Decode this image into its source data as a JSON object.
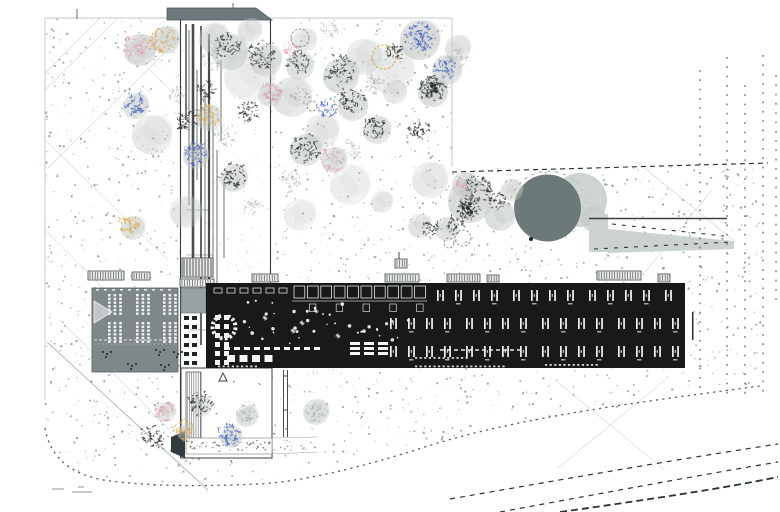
{
  "title": "Architectural site plan",
  "canvas": {
    "w": 780,
    "h": 512,
    "bg": "#ffffff"
  },
  "palette": {
    "ink": "#1c2022",
    "building_black": "#17191a",
    "building_gray": "#7f8789",
    "cap_gray": "#6e797c",
    "circle_gray": "#6b7a78",
    "ramp_gray": "#ccd3cf",
    "canopy": "#c2c8c4",
    "stipple": "#76857f",
    "white": "#f4f5f4",
    "tree_black": "#23282a",
    "tree_dark": "#2b3234",
    "tree_pink": "#dc9aa6",
    "tree_blue": "#3a57c8",
    "tree_orange": "#dfa23e",
    "tree_gray": "#9aa39e"
  },
  "ground": {
    "field_polygon": [
      [
        45,
        18
      ],
      [
        452,
        18
      ],
      [
        452,
        167
      ],
      [
        766,
        167
      ],
      [
        760,
        386
      ],
      [
        640,
        404
      ],
      [
        520,
        423
      ],
      [
        428,
        444
      ],
      [
        340,
        463
      ],
      [
        258,
        484
      ],
      [
        150,
        486
      ],
      [
        95,
        480
      ],
      [
        60,
        462
      ],
      [
        45,
        430
      ]
    ],
    "stipple_count": 2200,
    "tick_count": 140,
    "border_lines": [
      [
        45,
        18,
        452,
        18
      ],
      [
        45,
        18,
        45,
        400
      ],
      [
        452,
        18,
        452,
        167
      ]
    ],
    "diagonals": [
      [
        118,
        18,
        45,
        90,
        0.3
      ],
      [
        200,
        18,
        48,
        168,
        0.3
      ],
      [
        45,
        140,
        168,
        260,
        0.28
      ],
      [
        45,
        230,
        150,
        335,
        0.28
      ],
      [
        60,
        320,
        170,
        430,
        0.3
      ],
      [
        140,
        60,
        262,
        182,
        0.22
      ],
      [
        100,
        18,
        45,
        73,
        0.3
      ],
      [
        637,
        162,
        733,
        240,
        0.35
      ],
      [
        712,
        190,
        645,
        272,
        0.3
      ],
      [
        555,
        380,
        665,
        470,
        0.3
      ],
      [
        665,
        380,
        558,
        468,
        0.3
      ],
      [
        47,
        342,
        208,
        490,
        0.55
      ]
    ],
    "boundary_path": "M45,428 C50,458 72,476 110,481 C160,487 210,486 258,484 C300,482 360,468 428,446 C520,417 640,402 760,386",
    "top_ticks": [
      [
        77,
        9,
        77,
        19
      ],
      [
        233,
        3,
        233,
        9
      ]
    ],
    "bottom_marks": [
      [
        52,
        489,
        64,
        489
      ],
      [
        72,
        492,
        92,
        492
      ],
      [
        78,
        487,
        84,
        487
      ]
    ]
  },
  "strip": {
    "underlay": [
      181,
      20,
      89,
      350
    ],
    "cap": [
      [
        167,
        8
      ],
      [
        256,
        8
      ],
      [
        272,
        20
      ],
      [
        167,
        20
      ]
    ],
    "walls": [
      [
        180.5,
        20,
        180.5,
        458
      ],
      [
        270.5,
        20,
        270.5,
        458
      ]
    ],
    "inner_lines": [
      [
        186,
        24,
        120,
        1.5
      ],
      [
        189,
        30,
        205,
        0.8
      ],
      [
        193,
        24,
        260,
        2.6
      ],
      [
        197,
        70,
        180,
        0.8
      ],
      [
        201,
        26,
        345,
        1.7
      ],
      [
        205,
        90,
        300,
        0.8
      ],
      [
        209,
        34,
        345,
        2.2
      ],
      [
        213,
        120,
        262,
        0.8
      ],
      [
        217,
        150,
        298,
        0.8
      ],
      [
        221,
        60,
        140,
        0.8
      ],
      [
        224,
        180,
        258,
        0.8
      ]
    ],
    "steps": [
      [
        186,
        210,
        209
      ],
      [
        186,
        150,
        201
      ],
      [
        193,
        110,
        209
      ],
      [
        186,
        255,
        213
      ],
      [
        189,
        330,
        209
      ]
    ],
    "hatch_top": [
      182,
      258,
      31,
      19
    ],
    "ladder": [
      180,
      279,
      34,
      8
    ],
    "gray_square": [
      181,
      288,
      25,
      25
    ],
    "pair_rows": {
      "x": [
        184,
        192
      ],
      "y0": 316,
      "step": 9,
      "rows": 6,
      "w": 5,
      "h": 4
    }
  },
  "courtyard": {
    "rect": [
      181,
      368,
      91,
      90
    ],
    "stair_band": [
      186,
      372,
      15,
      66
    ],
    "wedge": [
      [
        171,
        437
      ],
      [
        185,
        431
      ],
      [
        185,
        458
      ],
      [
        171,
        452
      ]
    ],
    "path_band": [
      186,
      438,
      86,
      16
    ],
    "ext_lines": [
      [
        272,
        438,
        318,
        437
      ],
      [
        272,
        454,
        318,
        452
      ]
    ],
    "triangle": [
      223,
      377,
      8
    ],
    "ladder_lines": [
      [
        283.5,
        370,
        283.5,
        437
      ],
      [
        287.5,
        370,
        287.5,
        437
      ]
    ],
    "ladder_rungs": [
      [
        283.5,
        376,
        287.5,
        376
      ],
      [
        283.5,
        410,
        287.5,
        410
      ]
    ]
  },
  "plaza": {
    "ring_path": "M509,206 A40,40 0 0 1 588,204",
    "crescents": [
      [
        580,
        200,
        27,
        0.85
      ],
      [
        594,
        219,
        13,
        0.7
      ]
    ],
    "circle": [
      547.5,
      208,
      33.5
    ],
    "mark": [
      531,
      239
    ],
    "ramp_block": [
      589,
      214,
      19,
      38
    ],
    "ramp_wedge": [
      [
        608,
        229
      ],
      [
        734,
        241
      ],
      [
        734,
        249
      ],
      [
        608,
        253
      ]
    ],
    "ramp_line": [
      589,
      218.5,
      727,
      218.5
    ],
    "dash_rows": [
      "M612,224 L724,236",
      "M594,249 L731,242"
    ]
  },
  "vegetation": {
    "canopies": [
      [
        140,
        50,
        16,
        0.5
      ],
      [
        166,
        40,
        14,
        0.45
      ],
      [
        214,
        38,
        15,
        0.4
      ],
      [
        250,
        30,
        12,
        0.35
      ],
      [
        230,
        52,
        18,
        0.45
      ],
      [
        266,
        60,
        16,
        0.4
      ],
      [
        300,
        66,
        14,
        0.4
      ],
      [
        341,
        76,
        18,
        0.45
      ],
      [
        353,
        106,
        15,
        0.4
      ],
      [
        420,
        40,
        20,
        0.5
      ],
      [
        447,
        70,
        15,
        0.45
      ],
      [
        433,
        92,
        15,
        0.5
      ],
      [
        377,
        130,
        14,
        0.4
      ],
      [
        306,
        150,
        16,
        0.45
      ],
      [
        334,
        160,
        13,
        0.4
      ],
      [
        234,
        178,
        14,
        0.4
      ],
      [
        196,
        156,
        13,
        0.4
      ],
      [
        136,
        106,
        13,
        0.4
      ],
      [
        209,
        118,
        13,
        0.4
      ],
      [
        133,
        228,
        12,
        0.4
      ],
      [
        152,
        135,
        20,
        0.3
      ],
      [
        186,
        212,
        16,
        0.3
      ],
      [
        292,
        97,
        20,
        0.35
      ],
      [
        322,
        131,
        17,
        0.3
      ],
      [
        364,
        57,
        18,
        0.3
      ],
      [
        470,
        201,
        22,
        0.5
      ],
      [
        500,
        216,
        15,
        0.45
      ],
      [
        447,
        229,
        12,
        0.4
      ],
      [
        512,
        190,
        11,
        0.4
      ],
      [
        465,
        185,
        13,
        0.45
      ],
      [
        247,
        416,
        11,
        0.4
      ],
      [
        316,
        412,
        13,
        0.4
      ],
      [
        201,
        406,
        11,
        0.35
      ],
      [
        166,
        412,
        10,
        0.35
      ],
      [
        231,
        437,
        11,
        0.4
      ],
      [
        186,
        432,
        9,
        0.35
      ],
      [
        420,
        226,
        12,
        0.35
      ],
      [
        382,
        202,
        11,
        0.3
      ],
      [
        270,
        95,
        12,
        0.35
      ],
      [
        305,
        40,
        12,
        0.3
      ],
      [
        458,
        48,
        13,
        0.35
      ],
      [
        395,
        92,
        12,
        0.3
      ],
      [
        250,
        75,
        26,
        0.22
      ],
      [
        390,
        70,
        24,
        0.22
      ],
      [
        350,
        185,
        20,
        0.22
      ],
      [
        430,
        180,
        18,
        0.28
      ],
      [
        300,
        215,
        16,
        0.22
      ]
    ],
    "rings": [
      [
        300,
        38,
        9,
        "#8b938f"
      ],
      [
        312,
        106,
        5,
        "#8b938f"
      ],
      [
        384,
        57,
        12,
        "#dfa23e"
      ],
      [
        463,
        238,
        8,
        "#8b938f"
      ],
      [
        340,
        100,
        6,
        "#9aa29d"
      ],
      [
        449,
        243,
        5,
        "#8b938f"
      ]
    ],
    "trees": [
      [
        228,
        45,
        "k",
        13,
        55
      ],
      [
        262,
        55,
        "k",
        15,
        65
      ],
      [
        298,
        62,
        "k",
        11,
        45
      ],
      [
        340,
        70,
        "k",
        15,
        65
      ],
      [
        352,
        100,
        "k",
        13,
        55
      ],
      [
        305,
        148,
        "k",
        15,
        60
      ],
      [
        233,
        176,
        "k",
        13,
        55
      ],
      [
        205,
        90,
        "k",
        9,
        35
      ],
      [
        186,
        120,
        "k",
        11,
        45
      ],
      [
        248,
        112,
        "k",
        11,
        45
      ],
      [
        375,
        128,
        "k",
        11,
        45
      ],
      [
        418,
        130,
        "k",
        11,
        40
      ],
      [
        395,
        52,
        "k",
        9,
        35
      ],
      [
        432,
        88,
        "d",
        13,
        90
      ],
      [
        468,
        208,
        "d",
        11,
        80
      ],
      [
        478,
        188,
        "k",
        13,
        60
      ],
      [
        455,
        225,
        "k",
        9,
        35
      ],
      [
        497,
        200,
        "k",
        9,
        35
      ],
      [
        430,
        228,
        "k",
        9,
        32
      ],
      [
        200,
        403,
        "k",
        12,
        50
      ],
      [
        153,
        436,
        "k",
        12,
        50
      ],
      [
        210,
        60,
        "g",
        11,
        40
      ],
      [
        178,
        95,
        "g",
        9,
        32
      ],
      [
        225,
        135,
        "g",
        11,
        40
      ],
      [
        290,
        180,
        "g",
        11,
        40
      ],
      [
        252,
        208,
        "g",
        9,
        32
      ],
      [
        330,
        30,
        "g",
        9,
        32
      ],
      [
        375,
        85,
        "g",
        10,
        34
      ],
      [
        458,
        58,
        "g",
        9,
        30
      ],
      [
        247,
        412,
        "g",
        11,
        42
      ],
      [
        316,
        412,
        "g",
        11,
        42
      ],
      [
        352,
        150,
        "g",
        8,
        26
      ],
      [
        300,
        95,
        "g",
        9,
        30
      ],
      [
        137,
        47,
        "p",
        13,
        55
      ],
      [
        270,
        93,
        "p",
        11,
        42
      ],
      [
        333,
        158,
        "p",
        13,
        52
      ],
      [
        164,
        410,
        "p",
        11,
        42
      ],
      [
        462,
        184,
        "p",
        7,
        24
      ],
      [
        290,
        48,
        "p",
        7,
        22
      ],
      [
        135,
        103,
        "b",
        12,
        50
      ],
      [
        420,
        37,
        "b",
        15,
        80
      ],
      [
        445,
        68,
        "b",
        11,
        45
      ],
      [
        327,
        110,
        "b",
        9,
        35
      ],
      [
        195,
        153,
        "b",
        12,
        50
      ],
      [
        230,
        435,
        "b",
        12,
        52
      ],
      [
        163,
        40,
        "o",
        13,
        55
      ],
      [
        208,
        115,
        "o",
        11,
        48
      ],
      [
        130,
        225,
        "o",
        11,
        48
      ],
      [
        185,
        430,
        "o",
        11,
        45
      ]
    ]
  },
  "buildings": {
    "west": {
      "rect": [
        92,
        288,
        86,
        84
      ],
      "triangle": [
        [
          94,
          301
        ],
        [
          94,
          323
        ],
        [
          112,
          312
        ]
      ],
      "table_groups_x": [
        108,
        136,
        163
      ],
      "table_bands_y": [
        294,
        322
      ],
      "scallop_y": 340,
      "dot_clusters": [
        [
          103,
          352
        ],
        [
          156,
          350
        ],
        [
          174,
          352
        ],
        [
          128,
          364
        ],
        [
          161,
          365
        ]
      ],
      "tick_row": {
        "y": 289,
        "x0": 96,
        "x1": 172,
        "step": 8
      }
    },
    "main": {
      "rect": [
        206,
        283,
        479,
        85
      ],
      "antenna": [
        692,
        312,
        1.5,
        28
      ],
      "l_row": {
        "y": 288,
        "x0": 214,
        "x1": 287,
        "step": 13
      },
      "rooms": {
        "x0": 294,
        "n": 10,
        "step": 13.4,
        "y": 286,
        "w": 10.8,
        "h": 12,
        "line_y": 301,
        "line_x": [
          292,
          427
        ]
      },
      "grid": {
        "rows": [
          [
            437,
            290,
            681
          ],
          [
            390,
            318,
            681
          ],
          [
            390,
            346,
            681
          ]
        ],
        "pitch": 18,
        "group": 4,
        "ggap": 4
      },
      "stair": [
        224,
        327,
        11.5
      ],
      "dots_regions": [
        [
          244,
          300,
          106,
          46,
          26
        ],
        [
          352,
          316,
          58,
          24,
          12
        ]
      ],
      "stars": [
        [
          265,
          318
        ],
        [
          293,
          331
        ],
        [
          316,
          311
        ],
        [
          338,
          336
        ],
        [
          302,
          323
        ]
      ],
      "pairs": {
        "x": [
          215,
          224
        ],
        "y0": 315,
        "step": 9,
        "rows": 6
      },
      "dash_rowA": {
        "y": 347,
        "x0": 224,
        "x1": 322
      },
      "square_row": {
        "y": 355,
        "x0": 227,
        "x1": 277,
        "w": 8,
        "h": 7,
        "gap": 4.5
      },
      "stacks": {
        "x": [
          350,
          364,
          378
        ],
        "y": [
          342,
          347,
          352
        ],
        "w": 10,
        "h": 3
      },
      "dash_line": [
        440,
        350,
        524
      ],
      "noise_rows": [
        [
          218,
          258,
          365.5
        ],
        [
          415,
          505,
          365.5
        ],
        [
          545,
          600,
          364
        ],
        [
          415,
          470,
          357
        ]
      ]
    },
    "vents": [
      [
        252,
        274,
        26,
        8
      ],
      [
        385,
        274,
        34,
        8
      ],
      [
        447,
        274,
        33,
        8
      ],
      [
        487,
        275,
        12,
        7
      ],
      [
        597,
        271,
        44,
        9
      ],
      [
        658,
        274,
        12,
        8
      ],
      [
        395,
        259,
        12,
        9
      ],
      [
        88,
        271,
        36,
        9
      ],
      [
        132,
        272,
        18,
        8
      ]
    ],
    "antenna_line": [
      399,
      252,
      399,
      259
    ]
  },
  "roads": {
    "v_dashes": [
      [
        700,
        70,
        395
      ],
      [
        727,
        57,
        400
      ],
      [
        745,
        85,
        398
      ],
      [
        763,
        55,
        396
      ],
      [
        776,
        75,
        300
      ]
    ],
    "h_boundary": "M452,172 L768,163",
    "sweeps": [
      [
        "M450,499 C560,480 660,462 778,444",
        1.2,
        "5 5"
      ],
      [
        "M500,512 C620,490 700,475 778,462",
        1.2,
        "5 5"
      ],
      [
        "M560,512 C660,498 724,488 778,477",
        1.8,
        "7 4"
      ]
    ]
  }
}
